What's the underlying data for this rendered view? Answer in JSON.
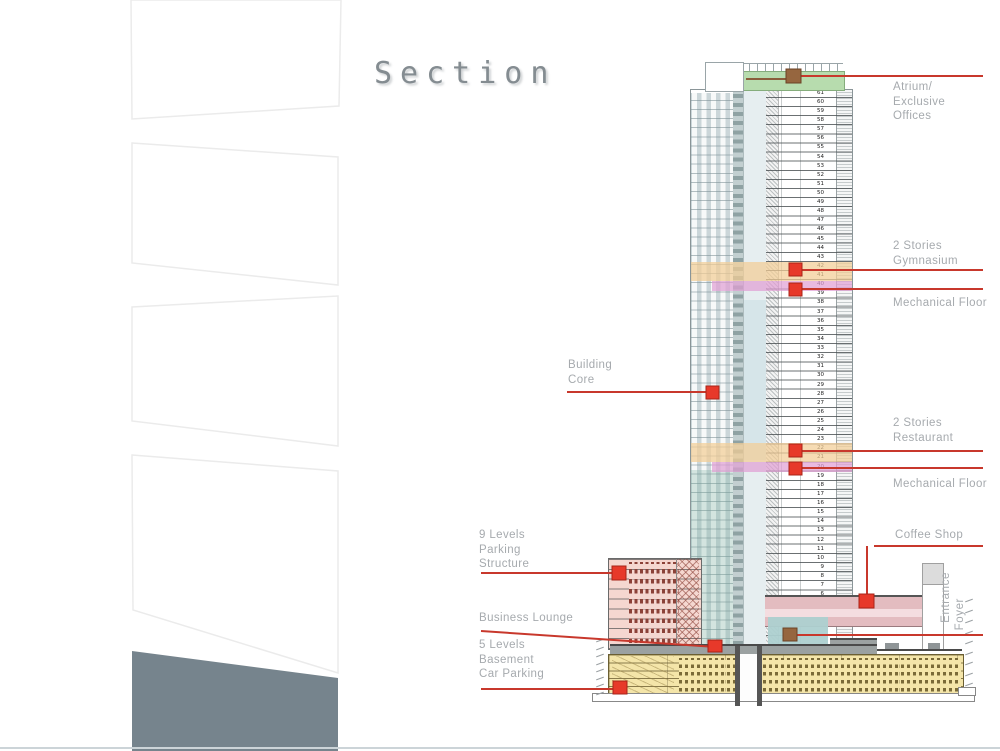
{
  "page": {
    "title": "Section"
  },
  "drawing": {
    "annotations": {
      "atrium": [
        "Atrium/",
        "Exclusive",
        "Offices"
      ],
      "gymnasium": [
        "2 Stories",
        "Gymnasium"
      ],
      "mechanical_upper": [
        "Mechanical Floor"
      ],
      "building_core": [
        "Building",
        "Core"
      ],
      "restaurant": [
        "2 Stories",
        "Restaurant"
      ],
      "mechanical_lower": [
        "Mechanical Floor"
      ],
      "coffee_shop": [
        "Coffee Shop"
      ],
      "entrance_foyer": [
        "Entrance",
        "Foyer"
      ],
      "parking_structure": [
        "9 Levels",
        "Parking",
        "Structure"
      ],
      "business_lounge": [
        "Business Lounge"
      ],
      "basement_parking": [
        "5 Levels",
        "Basement",
        "Car Parking"
      ]
    },
    "floor_numbers": [
      61,
      60,
      59,
      58,
      57,
      56,
      55,
      54,
      53,
      52,
      51,
      50,
      49,
      48,
      47,
      46,
      45,
      44,
      43,
      42,
      41,
      40,
      39,
      38,
      37,
      36,
      35,
      34,
      33,
      32,
      31,
      30,
      29,
      28,
      27,
      26,
      25,
      24,
      23,
      22,
      21,
      20,
      19,
      18,
      17,
      16,
      15,
      14,
      13,
      12,
      11,
      10,
      9,
      8,
      7,
      6,
      5
    ],
    "levels": {
      "tower_floors": 61,
      "parking_levels": 9,
      "basement_levels": 5
    },
    "colors": {
      "leader_red": "#c8382c",
      "marker_red": "#e7392a",
      "marker_brown": "#96663f",
      "atrium_green": "#b7dcae",
      "stories_orange": "#f3d3a2",
      "mechanical_purple": "#e0a0d4",
      "parking_pink": "#f5d7d0",
      "basement_yellow": "#f4e5a9",
      "lounge_teal": "#add0d0",
      "slate_accent": "#76848d"
    }
  }
}
